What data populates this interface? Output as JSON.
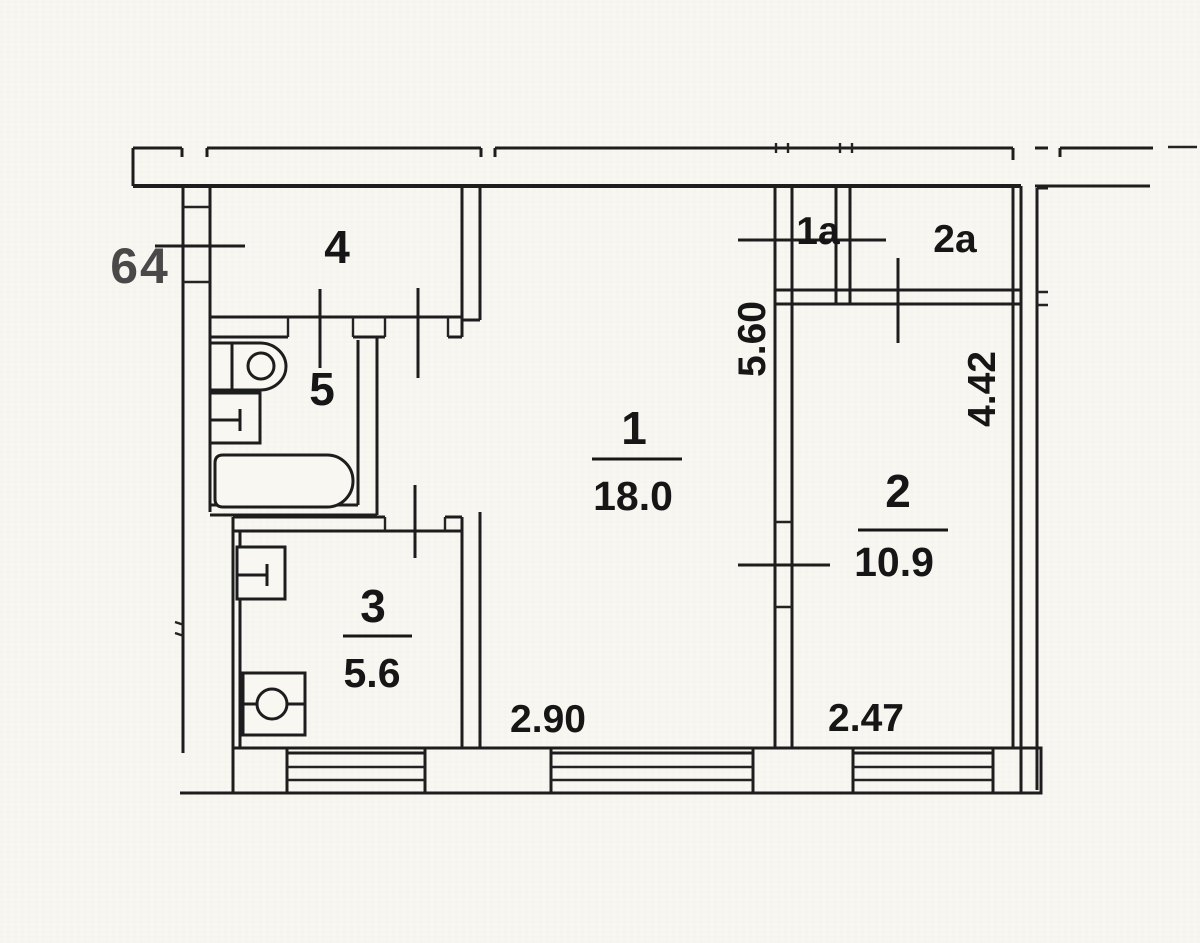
{
  "plan": {
    "apartment_number": "64",
    "rooms": [
      {
        "number": "1",
        "area": "18.0"
      },
      {
        "number": "2",
        "area": "10.9"
      },
      {
        "number": "3",
        "area": "5.6"
      },
      {
        "number": "4"
      },
      {
        "number": "5"
      },
      {
        "number": "1a"
      },
      {
        "number": "2a"
      }
    ],
    "dimensions": {
      "room1_window_width": "2.90",
      "room2_window_width": "2.47",
      "left_section_height": "5.60",
      "room2_height": "4.42"
    },
    "colors": {
      "ink": "#1d1d1d",
      "paper": "#f8f7f2"
    }
  }
}
